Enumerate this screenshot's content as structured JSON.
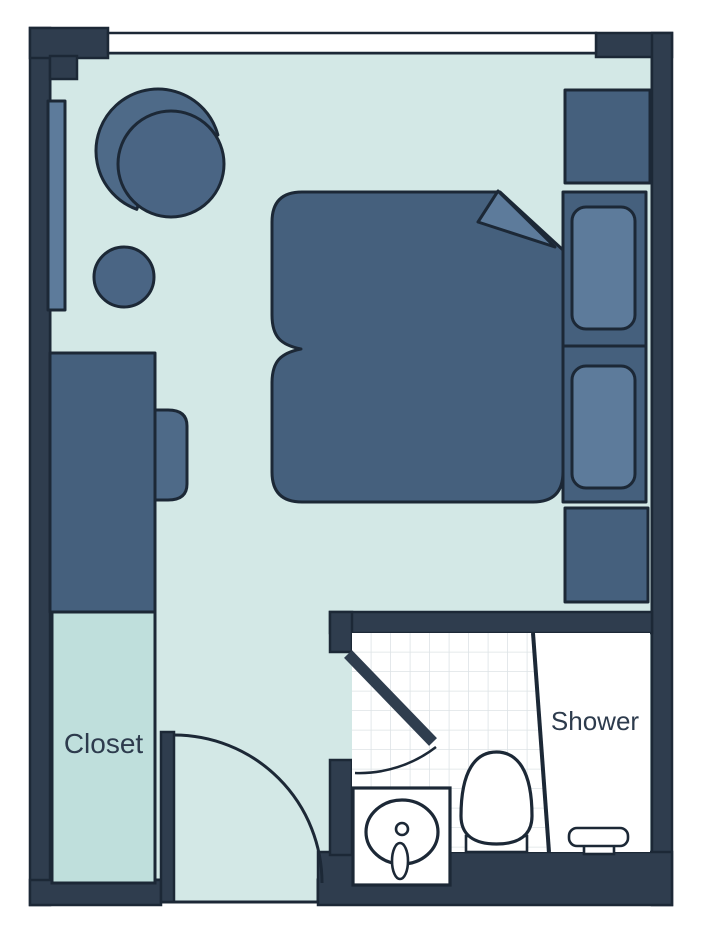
{
  "type": "floor-plan",
  "title": "studio room floor plan",
  "labels": {
    "closet": "Closet",
    "shower": "Shower"
  },
  "palette": {
    "wall": "#2f3d4e",
    "outline": "#1c2836",
    "floor": "#d3e8e6",
    "closet_floor": "#bfdfdc",
    "furniture_dark": "#45607d",
    "furniture_medium": "#4e6a88",
    "furniture_seat": "#4a6584",
    "furniture_light": "#5d7b9b",
    "bath_floor": "#ffffff",
    "window_white": "#ffffff",
    "tile_line": "#dde3e6",
    "label_text": "#2d3b4d"
  },
  "furniture_icons": [
    "armchair-icon",
    "side-table-icon",
    "desk-icon",
    "desk-chair-icon",
    "radiator-window-icon",
    "double-bed-icon",
    "bed-fold-icon",
    "pillow-icon",
    "nightstand-icon",
    "entry-door-icon",
    "bathroom-door-icon",
    "sink-icon",
    "toilet-icon",
    "shower-divider-icon",
    "shower-bench-icon"
  ]
}
